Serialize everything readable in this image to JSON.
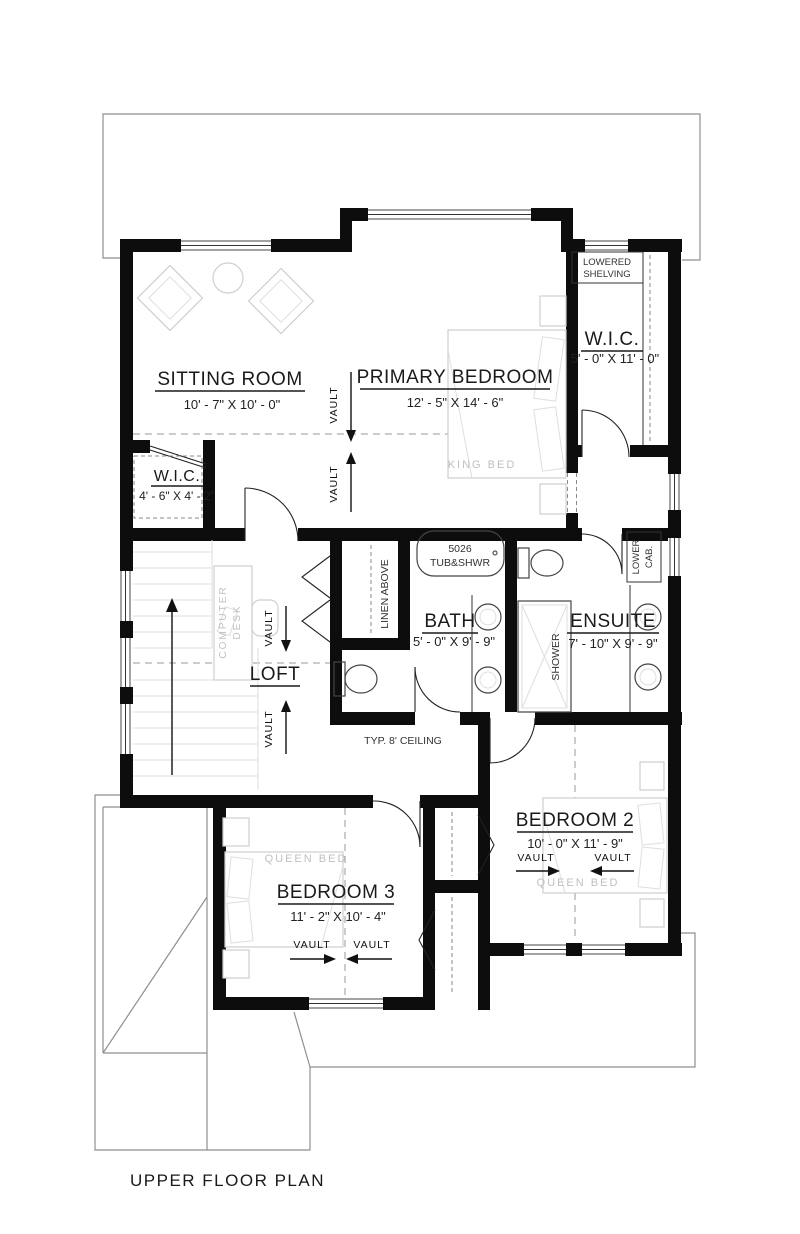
{
  "footer": {
    "title": "UPPER FLOOR PLAN"
  },
  "rooms": {
    "sitting_room": {
      "name": "SITTING ROOM",
      "dims": "10' - 7\" X 10' - 0\""
    },
    "primary_bedroom": {
      "name": "PRIMARY BEDROOM",
      "dims": "12' - 5\" X 14' - 6\""
    },
    "wic_right": {
      "name": "W.I.C.",
      "dims": "5' - 0\" X 11' - 0\""
    },
    "wic_left": {
      "name": "W.I.C.",
      "dims": "4' - 6\" X 4' - 2\""
    },
    "bath": {
      "name": "BATH",
      "dims": "5' - 0\" X 9' - 9\""
    },
    "ensuite": {
      "name": "ENSUITE",
      "dims": "7' - 10\" X 9' - 9\""
    },
    "loft": {
      "name": "LOFT"
    },
    "bedroom2": {
      "name": "BEDROOM 2",
      "dims": "10' - 0\" X 11' - 9\""
    },
    "bedroom3": {
      "name": "BEDROOM 3",
      "dims": "11' - 2\" X 10' - 4\""
    }
  },
  "annotations": {
    "vault": "VAULT",
    "king_bed": "KING BED",
    "queen_bed": "QUEEN BED",
    "lowered_shelving_1": "LOWERED",
    "lowered_shelving_2": "SHELVING",
    "linen_above": "LINEN ABOVE",
    "tub_model": "5026",
    "tub_type": "TUB&SHWR",
    "shower": "SHOWER",
    "lower_cab_1": "LOWER",
    "lower_cab_2": "CAB.",
    "computer_desk_1": "COMPUTER",
    "computer_desk_2": "DESK",
    "typ_ceiling": "TYP. 8' CEILING"
  },
  "colors": {
    "wall": "#0d0d0d",
    "roof_line": "#8f8f8f",
    "dashed_line": "#9a9a9a",
    "furniture": "#cfcfcf",
    "furniture_text": "#c0c0c0",
    "text": "#1a1a1a"
  }
}
